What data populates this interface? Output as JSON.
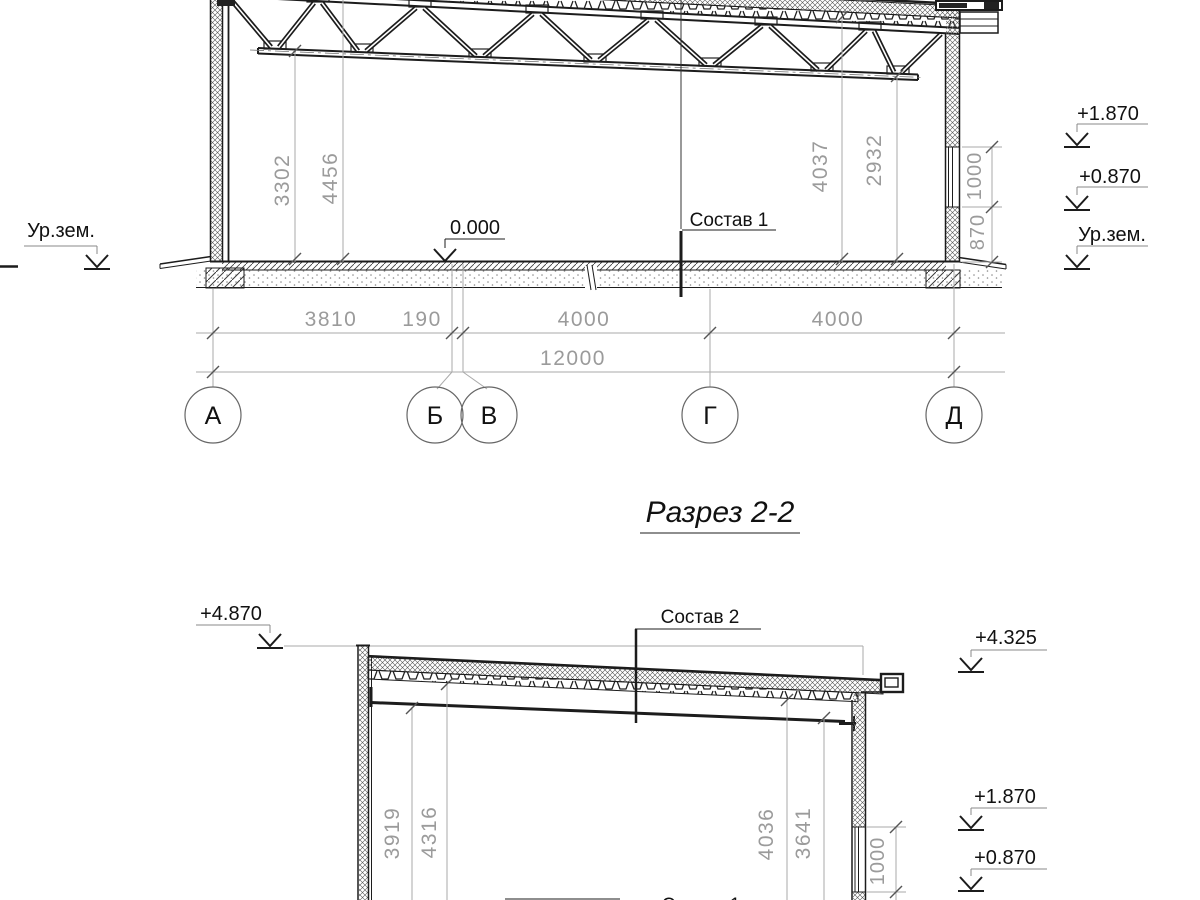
{
  "title": "Разрез 2-2",
  "s1": {
    "labels": {
      "sostav1": "Состав 1",
      "zero": "0.000",
      "ur_left": "Ур.зем.",
      "ur_right": "Ур.зем.",
      "l1870": "+1.870",
      "l0870": "+0.870"
    },
    "dims": {
      "d3302": "3302",
      "d4456": "4456",
      "d4037": "4037",
      "d2932": "2932",
      "w1000": "1000",
      "w870": "870",
      "h3810": "3810",
      "h190": "190",
      "h4000a": "4000",
      "h4000b": "4000",
      "h12000": "12000"
    },
    "axes": [
      "А",
      "Б",
      "В",
      "Г",
      "Д"
    ]
  },
  "s2": {
    "labels": {
      "sostav2": "Состав 2",
      "sostav1": "Состав 1",
      "l4870": "+4.870",
      "l4325": "+4.325",
      "l1870": "+1.870",
      "l0870": "+0.870"
    },
    "dims": {
      "d3919": "3919",
      "d4316": "4316",
      "d4036": "4036",
      "d3641": "3641",
      "w1000": "1000"
    }
  }
}
